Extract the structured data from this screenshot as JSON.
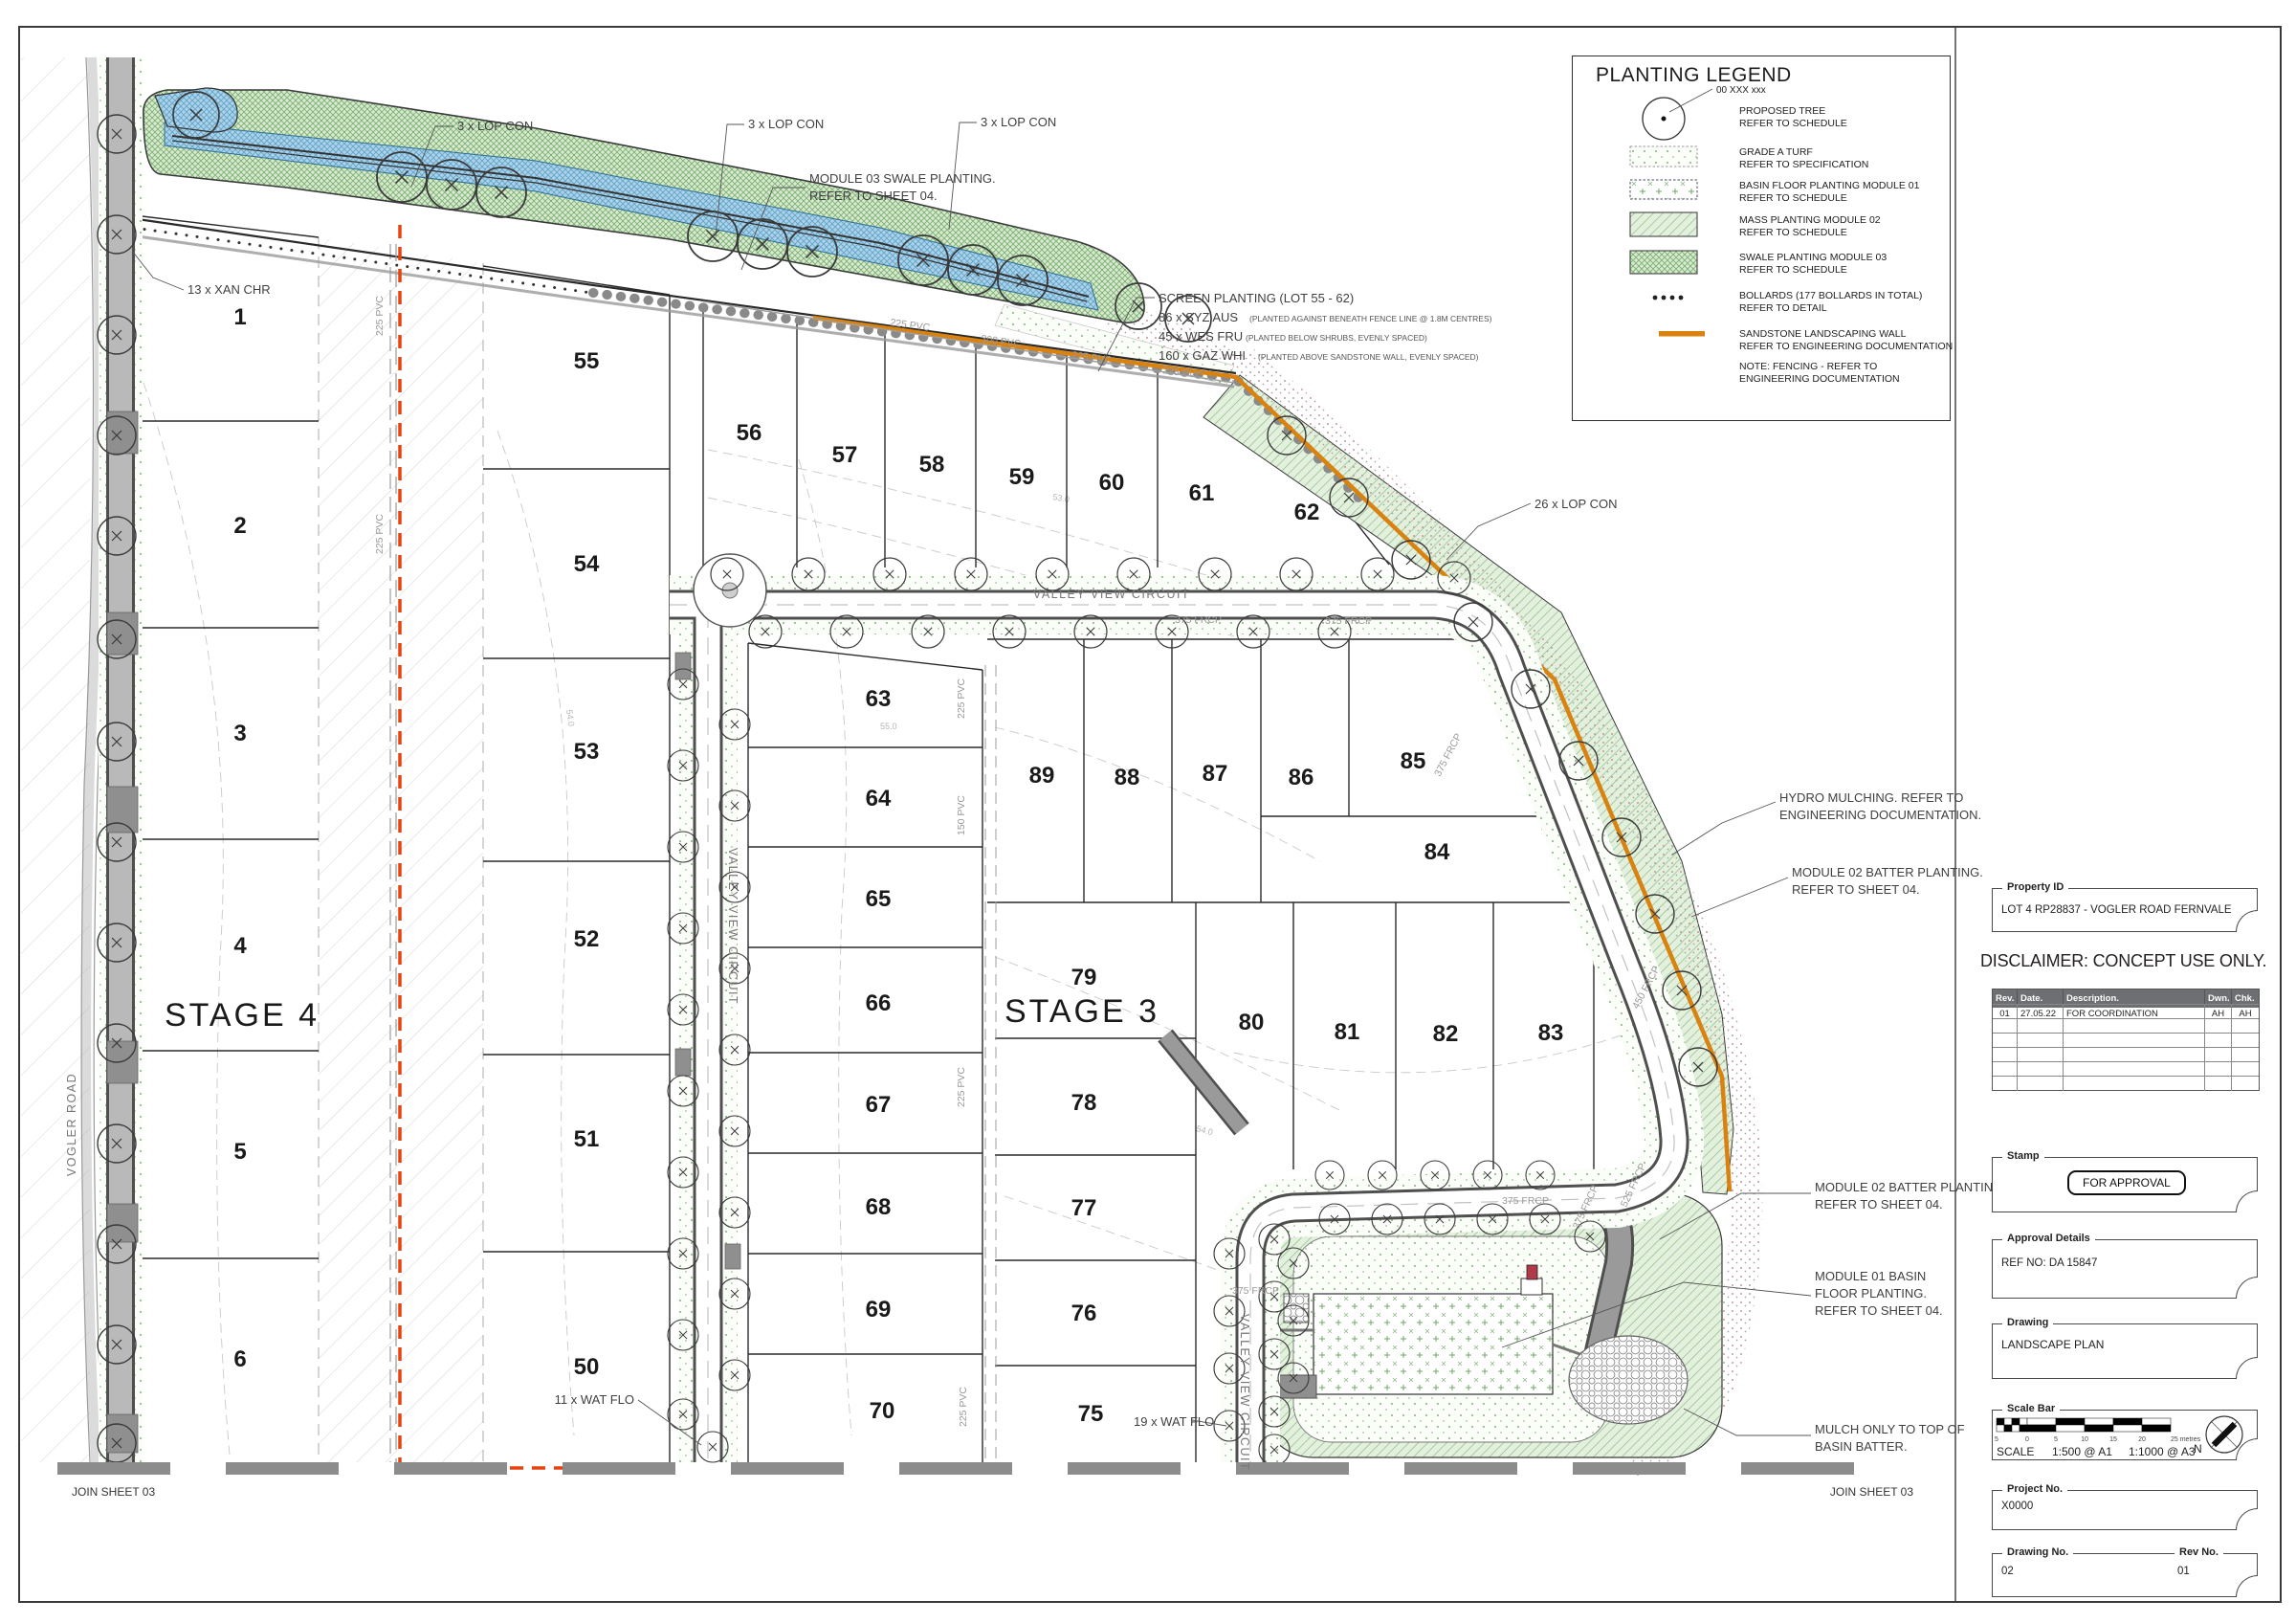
{
  "colors": {
    "sandstone_wall": "#d9820f",
    "stage_boundary": "#e8420e",
    "mass_planting_green": "#8bbd85",
    "swale_blue": "#7fb6d6",
    "road_grey": "#8f8f8f"
  },
  "legend": {
    "title": "PLANTING LEGEND",
    "tree_tag": "00 XXX xxx",
    "items": [
      {
        "name": "proposed-tree",
        "line1": "PROPOSED TREE",
        "line2": "REFER TO SCHEDULE"
      },
      {
        "name": "grade-a-turf",
        "line1": "GRADE A TURF",
        "line2": "REFER TO SPECIFICATION"
      },
      {
        "name": "basin-floor-planting",
        "line1": "BASIN FLOOR PLANTING MODULE 01",
        "line2": "REFER TO SCHEDULE"
      },
      {
        "name": "mass-planting",
        "line1": "MASS PLANTING MODULE 02",
        "line2": "REFER TO SCHEDULE"
      },
      {
        "name": "swale-planting",
        "line1": "SWALE PLANTING MODULE 03",
        "line2": "REFER TO SCHEDULE"
      },
      {
        "name": "bollards",
        "line1": "BOLLARDS (177 BOLLARDS IN TOTAL)",
        "line2": "REFER TO DETAIL"
      },
      {
        "name": "sandstone-wall",
        "line1": "SANDSTONE LANDSCAPING WALL",
        "line2": "REFER TO ENGINEERING DOCUMENTATION"
      },
      {
        "name": "fencing-note",
        "line1": "NOTE: FENCING - REFER TO",
        "line2": "ENGINEERING DOCUMENTATION"
      }
    ]
  },
  "title_block": {
    "property_label": "Property ID",
    "property_value": "LOT 4 RP28837 - VOGLER ROAD FERNVALE",
    "disclaimer": "DISCLAIMER: CONCEPT USE ONLY.",
    "rev_table": {
      "headers": [
        "Rev.",
        "Date.",
        "Description.",
        "Dwn.",
        "Chk."
      ],
      "rows": [
        [
          "01",
          "27.05.22",
          "FOR COORDINATION",
          "AH",
          "AH"
        ]
      ]
    },
    "stamp_label": "Stamp",
    "stamp_value": "FOR APPROVAL",
    "approval_label": "Approval Details",
    "approval_value": "REF NO: DA 15847",
    "drawing_label": "Drawing",
    "drawing_value": "LANDSCAPE PLAN",
    "scalebar_label": "Scale Bar",
    "scale_ticks": [
      "5",
      "0",
      "5",
      "10",
      "15",
      "20",
      "25 metres"
    ],
    "scale_word": "SCALE",
    "scale_a1": "1:500 @ A1",
    "scale_a3": "1:1000 @ A3",
    "north_label": "N",
    "project_label": "Project No.",
    "project_value": "X0000",
    "drawing_no_label": "Drawing No.",
    "drawing_no_value": "02",
    "rev_no_label": "Rev No.",
    "rev_no_value": "01"
  },
  "plan": {
    "stage4": "STAGE 4",
    "stage3": "STAGE 3",
    "join_sheet": "JOIN SHEET 03",
    "roads": {
      "vogler": "VOGLER ROAD",
      "valley_view": "VALLEY VIEW CIRCUIT"
    },
    "lots": {
      "stage4_col1": [
        "1",
        "2",
        "3",
        "4",
        "5",
        "6"
      ],
      "stage4_col2": [
        "55",
        "54",
        "53",
        "52",
        "51",
        "50"
      ],
      "north_row": [
        "56",
        "57",
        "58",
        "59",
        "60",
        "61",
        "62"
      ],
      "mid_col": [
        "63",
        "64",
        "65",
        "66",
        "67",
        "68",
        "69",
        "70"
      ],
      "east_block": [
        "89",
        "88",
        "87",
        "86",
        "85",
        "84"
      ],
      "south_col": [
        "79",
        "78",
        "77",
        "76",
        "75"
      ],
      "southeast_row": [
        "80",
        "81",
        "82",
        "83"
      ]
    },
    "callouts": {
      "lop3": "3 x LOP CON",
      "xan": "13 x XAN CHR",
      "lop26": "26 x LOP CON",
      "wat11": "11 x WAT FLO",
      "wat19": "19 x WAT FLO",
      "swale_module": [
        "MODULE 03 SWALE PLANTING.",
        "REFER TO SHEET 04."
      ],
      "screen_title": "SCREEN PLANTING (LOT 55 - 62)",
      "screen_items": [
        {
          "qty": "86 x SYZ AUS",
          "note": "(PLANTED AGAINST BENEATH FENCE LINE @ 1.8M CENTRES)"
        },
        {
          "qty": "45 x WES FRU",
          "note": "(PLANTED BELOW SHRUBS, EVENLY SPACED)"
        },
        {
          "qty": "160 x GAZ WHI",
          "note": "(PLANTED ABOVE SANDSTONE WALL, EVENLY SPACED)"
        }
      ],
      "hydro": [
        "HYDRO MULCHING. REFER TO",
        "ENGINEERING DOCUMENTATION."
      ],
      "batter_upper": [
        "MODULE 02 BATTER PLANTING.",
        "REFER TO SHEET 04."
      ],
      "batter_lower": [
        "MODULE 02 BATTER PLANTING.",
        "REFER TO SHEET 04."
      ],
      "basin_module": [
        "MODULE 01 BASIN",
        "FLOOR PLANTING.",
        "REFER TO SHEET 04."
      ],
      "mulch_note": [
        "MULCH ONLY TO TOP OF",
        "BASIN BATTER."
      ]
    },
    "pipes": {
      "pvc225": "225 PVC",
      "pvc300": "300 PVC",
      "pvc150": "150 PVC",
      "frcp375": "375 FRCP",
      "frcp450": "450 FRCP",
      "frcp525": "525 FRCP"
    },
    "contours": [
      "53.0",
      "54.0",
      "55.0",
      "56.0"
    ]
  }
}
